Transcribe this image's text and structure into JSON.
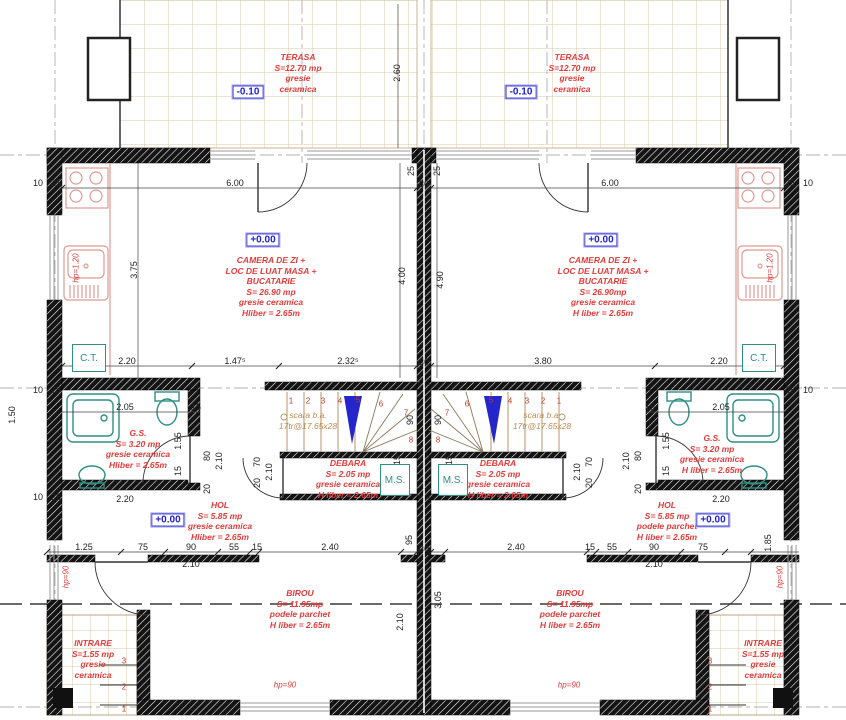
{
  "title": "Plan parter duplex",
  "colors": {
    "label_red": "#e23b3b",
    "marker_blue": "#1f1fcf",
    "fixture_teal": "#2e8f86",
    "tile_tan": "#d9c7a6",
    "stair_tan": "#b5946a",
    "wall_black": "#141414",
    "arrow_blue": "#2525cc",
    "kitchen_red": "#dd9a92",
    "axis_gray": "#b0b0b0"
  },
  "labels": [
    {
      "name": "terasa-left-label",
      "x": 298,
      "y": 52,
      "lines": [
        "TERASA",
        "S=12.70 mp",
        "gresie",
        "ceramica"
      ]
    },
    {
      "name": "terasa-right-label",
      "x": 572,
      "y": 52,
      "lines": [
        "TERASA",
        "S=12.70 mp",
        "gresie",
        "ceramica"
      ]
    },
    {
      "name": "living-left-label",
      "x": 271,
      "y": 255,
      "lines": [
        "CAMERA DE ZI +",
        "LOC DE LUAT MASA +",
        "BUCATARIE",
        "S= 26.90 mp",
        "gresie ceramica",
        "Hliber = 2.65m"
      ]
    },
    {
      "name": "living-right-label",
      "x": 603,
      "y": 255,
      "lines": [
        "CAMERA DE ZI +",
        "LOC DE LUAT MASA +",
        "BUCATARIE",
        "S= 26.90mp",
        "gresie ceramica",
        "H liber = 2.65m"
      ]
    },
    {
      "name": "gs-left-label",
      "x": 138,
      "y": 428,
      "lines": [
        "G.S.",
        "S= 3.20 mp",
        "gresie ceramica",
        "Hliber = 2.65m"
      ]
    },
    {
      "name": "gs-right-label",
      "x": 712,
      "y": 433,
      "lines": [
        "G.S.",
        "S= 3.20 mp",
        "gresie ceramica",
        "H liber = 2.65m"
      ]
    },
    {
      "name": "debara-left-label",
      "x": 348,
      "y": 458,
      "lines": [
        "DEBARA",
        "S= 2.05 mp",
        "gresie ceramica",
        "H liber = 2.65m"
      ]
    },
    {
      "name": "debara-right-label",
      "x": 498,
      "y": 458,
      "lines": [
        "DEBARA",
        "S= 2.05 mp",
        "gresie ceramica",
        "H liber = 2.65m"
      ]
    },
    {
      "name": "hol-left-label",
      "x": 220,
      "y": 500,
      "lines": [
        "HOL",
        "S= 5.85 mp",
        "gresie ceramica",
        "Hliber = 2.65m"
      ]
    },
    {
      "name": "hol-right-label",
      "x": 667,
      "y": 500,
      "lines": [
        "HOL",
        "S= 5.85 mp",
        "podele parchet",
        "H liber = 2.65m"
      ]
    },
    {
      "name": "birou-left-label",
      "x": 300,
      "y": 588,
      "lines": [
        "BIROU",
        "S= 11.95mp",
        "podele parchet",
        "H liber = 2.65m"
      ]
    },
    {
      "name": "birou-right-label",
      "x": 570,
      "y": 588,
      "lines": [
        "BIROU",
        "S= 11.95mp",
        "podele parchet",
        "H liber = 2.65m"
      ]
    },
    {
      "name": "intrare-left-label",
      "x": 93,
      "y": 638,
      "lines": [
        "INTRARE",
        "S=1.55 mp",
        "gresie",
        "ceramica"
      ]
    },
    {
      "name": "intrare-right-label",
      "x": 763,
      "y": 638,
      "lines": [
        "INTRARE",
        "S=1.55 mp",
        "gresie",
        "ceramica"
      ]
    },
    {
      "name": "stair-left-label",
      "x": 308,
      "y": 410,
      "cls": "tan",
      "lines": [
        "scara b.a.",
        "17tr@17.65x28"
      ]
    },
    {
      "name": "stair-right-label",
      "x": 542,
      "y": 410,
      "cls": "tan",
      "lines": [
        "scara b.a.",
        "17tr@17.65x28"
      ]
    }
  ],
  "levels": [
    {
      "t": "-0.10",
      "x": 248,
      "y": 92
    },
    {
      "t": "-0.10",
      "x": 521,
      "y": 92
    },
    {
      "t": "+0.00",
      "x": 263,
      "y": 240
    },
    {
      "t": "+0.00",
      "x": 601,
      "y": 240
    },
    {
      "t": "+0.00",
      "x": 168,
      "y": 520
    },
    {
      "t": "+0.00",
      "x": 713,
      "y": 520
    }
  ],
  "boxes": [
    {
      "t": "C.T.",
      "x": 72,
      "y": 344,
      "w": 32,
      "h": 26,
      "n": "ct-box-left"
    },
    {
      "t": "C.T.",
      "x": 742,
      "y": 344,
      "w": 32,
      "h": 26,
      "n": "ct-box-right"
    },
    {
      "t": "M.S.",
      "x": 380,
      "y": 464,
      "w": 28,
      "h": 30,
      "n": "ms-box-left"
    },
    {
      "t": "M.S.",
      "x": 438,
      "y": 464,
      "w": 28,
      "h": 30,
      "n": "ms-box-right"
    }
  ],
  "dims": [
    {
      "t": "10",
      "x": 38,
      "y": 183
    },
    {
      "t": "25",
      "x": 56,
      "y": 183
    },
    {
      "t": "6.00",
      "x": 235,
      "y": 183
    },
    {
      "t": "25",
      "x": 411,
      "y": 171,
      "r": 1
    },
    {
      "t": "30",
      "x": 424,
      "y": 184
    },
    {
      "t": "25",
      "x": 437,
      "y": 171,
      "r": 1
    },
    {
      "t": "6.00",
      "x": 610,
      "y": 183
    },
    {
      "t": "25",
      "x": 790,
      "y": 183
    },
    {
      "t": "10",
      "x": 808,
      "y": 183
    },
    {
      "t": "2.60",
      "x": 397,
      "y": 73,
      "r": 1
    },
    {
      "t": "3.75",
      "x": 134,
      "y": 270,
      "r": 1
    },
    {
      "t": "4.00",
      "x": 402,
      "y": 276,
      "r": 1
    },
    {
      "t": "4.90",
      "x": 440,
      "y": 280,
      "r": 1
    },
    {
      "t": "hp=1.20",
      "x": 76,
      "y": 268,
      "r": 1,
      "c": "red"
    },
    {
      "t": "hp=1.20",
      "x": 770,
      "y": 268,
      "r": 1,
      "c": "red"
    },
    {
      "t": "2.20",
      "x": 127,
      "y": 361
    },
    {
      "t": "1.47⁵",
      "x": 235,
      "y": 361
    },
    {
      "t": "2.32⁵",
      "x": 348,
      "y": 361
    },
    {
      "t": "30",
      "x": 424,
      "y": 362
    },
    {
      "t": "3.80",
      "x": 543,
      "y": 361
    },
    {
      "t": "2.20",
      "x": 719,
      "y": 361
    },
    {
      "t": "10",
      "x": 38,
      "y": 390
    },
    {
      "t": "25",
      "x": 56,
      "y": 390
    },
    {
      "t": "25",
      "x": 790,
      "y": 390
    },
    {
      "t": "10",
      "x": 808,
      "y": 390
    },
    {
      "t": "2.05",
      "x": 125,
      "y": 407
    },
    {
      "t": "15",
      "x": 196,
      "y": 407
    },
    {
      "t": "2.05",
      "x": 721,
      "y": 407
    },
    {
      "t": "15",
      "x": 650,
      "y": 407
    },
    {
      "t": "1.55",
      "x": 178,
      "y": 441,
      "r": 1
    },
    {
      "t": "15",
      "x": 178,
      "y": 471,
      "r": 1
    },
    {
      "t": "80",
      "x": 207,
      "y": 456,
      "r": 1
    },
    {
      "t": "2.10",
      "x": 219,
      "y": 461,
      "r": 1
    },
    {
      "t": "20",
      "x": 207,
      "y": 489,
      "r": 1
    },
    {
      "t": "1.55",
      "x": 666,
      "y": 441,
      "r": 1
    },
    {
      "t": "15",
      "x": 666,
      "y": 471,
      "r": 1
    },
    {
      "t": "80",
      "x": 638,
      "y": 456,
      "r": 1
    },
    {
      "t": "2.10",
      "x": 626,
      "y": 461,
      "r": 1
    },
    {
      "t": "20",
      "x": 638,
      "y": 489,
      "r": 1
    },
    {
      "t": "90",
      "x": 410,
      "y": 420,
      "r": 1
    },
    {
      "t": "90",
      "x": 438,
      "y": 420,
      "r": 1
    },
    {
      "t": "15",
      "x": 397,
      "y": 460,
      "r": 1
    },
    {
      "t": "85",
      "x": 397,
      "y": 482,
      "r": 1
    },
    {
      "t": "15",
      "x": 449,
      "y": 460,
      "r": 1
    },
    {
      "t": "85",
      "x": 449,
      "y": 482,
      "r": 1
    },
    {
      "t": "70",
      "x": 257,
      "y": 462,
      "r": 1
    },
    {
      "t": "20",
      "x": 257,
      "y": 483,
      "r": 1
    },
    {
      "t": "2.10",
      "x": 269,
      "y": 472,
      "r": 1
    },
    {
      "t": "70",
      "x": 589,
      "y": 462,
      "r": 1
    },
    {
      "t": "20",
      "x": 589,
      "y": 483,
      "r": 1
    },
    {
      "t": "2.10",
      "x": 577,
      "y": 472,
      "r": 1
    },
    {
      "t": "10",
      "x": 38,
      "y": 497
    },
    {
      "t": "25",
      "x": 56,
      "y": 497
    },
    {
      "t": "2.20",
      "x": 125,
      "y": 499
    },
    {
      "t": "2.20",
      "x": 721,
      "y": 499
    },
    {
      "t": "1.50",
      "x": 12,
      "y": 415,
      "r": 1
    },
    {
      "t": "1.85",
      "x": 768,
      "y": 543,
      "r": 1
    },
    {
      "t": "1.25",
      "x": 84,
      "y": 547
    },
    {
      "t": "75",
      "x": 143,
      "y": 547
    },
    {
      "t": "90",
      "x": 191,
      "y": 547
    },
    {
      "t": "55",
      "x": 234,
      "y": 547
    },
    {
      "t": "15",
      "x": 257,
      "y": 547
    },
    {
      "t": "2.40",
      "x": 330,
      "y": 547
    },
    {
      "t": "30",
      "x": 424,
      "y": 549
    },
    {
      "t": "95",
      "x": 409,
      "y": 540,
      "r": 1
    },
    {
      "t": "2.40",
      "x": 516,
      "y": 547
    },
    {
      "t": "15",
      "x": 590,
      "y": 547
    },
    {
      "t": "55",
      "x": 612,
      "y": 547
    },
    {
      "t": "90",
      "x": 654,
      "y": 547
    },
    {
      "t": "75",
      "x": 703,
      "y": 547
    },
    {
      "t": "2.10",
      "x": 191,
      "y": 564
    },
    {
      "t": "2.10",
      "x": 654,
      "y": 564
    },
    {
      "t": "hp=90",
      "x": 66,
      "y": 577,
      "r": 1,
      "c": "red"
    },
    {
      "t": "hp=90",
      "x": 780,
      "y": 577,
      "r": 1,
      "c": "red"
    },
    {
      "t": "hp=90",
      "x": 285,
      "y": 685,
      "c": "red"
    },
    {
      "t": "hp=90",
      "x": 569,
      "y": 685,
      "c": "red"
    },
    {
      "t": "2.10",
      "x": 400,
      "y": 622,
      "r": 1
    },
    {
      "t": "3.05",
      "x": 438,
      "y": 600,
      "r": 1
    }
  ],
  "stair_numbers": [
    {
      "t": "1",
      "x": 291,
      "y": 401
    },
    {
      "t": "2",
      "x": 308,
      "y": 401
    },
    {
      "t": "3",
      "x": 323,
      "y": 401
    },
    {
      "t": "4",
      "x": 340,
      "y": 401
    },
    {
      "t": "5",
      "x": 358,
      "y": 400
    },
    {
      "t": "6",
      "x": 381,
      "y": 404
    },
    {
      "t": "7",
      "x": 406,
      "y": 413
    },
    {
      "t": "8",
      "x": 411,
      "y": 440
    },
    {
      "t": "1",
      "x": 559,
      "y": 401
    },
    {
      "t": "2",
      "x": 543,
      "y": 401
    },
    {
      "t": "3",
      "x": 527,
      "y": 401
    },
    {
      "t": "4",
      "x": 510,
      "y": 401
    },
    {
      "t": "5",
      "x": 491,
      "y": 400
    },
    {
      "t": "6",
      "x": 467,
      "y": 404
    },
    {
      "t": "7",
      "x": 447,
      "y": 413
    },
    {
      "t": "8",
      "x": 438,
      "y": 440
    }
  ],
  "step_numbers": [
    {
      "t": "3",
      "x": 124,
      "y": 661
    },
    {
      "t": "2",
      "x": 124,
      "y": 687
    },
    {
      "t": "1",
      "x": 124,
      "y": 709
    },
    {
      "t": "3",
      "x": 710,
      "y": 661
    },
    {
      "t": "2",
      "x": 710,
      "y": 687
    },
    {
      "t": "1",
      "x": 710,
      "y": 709
    }
  ]
}
